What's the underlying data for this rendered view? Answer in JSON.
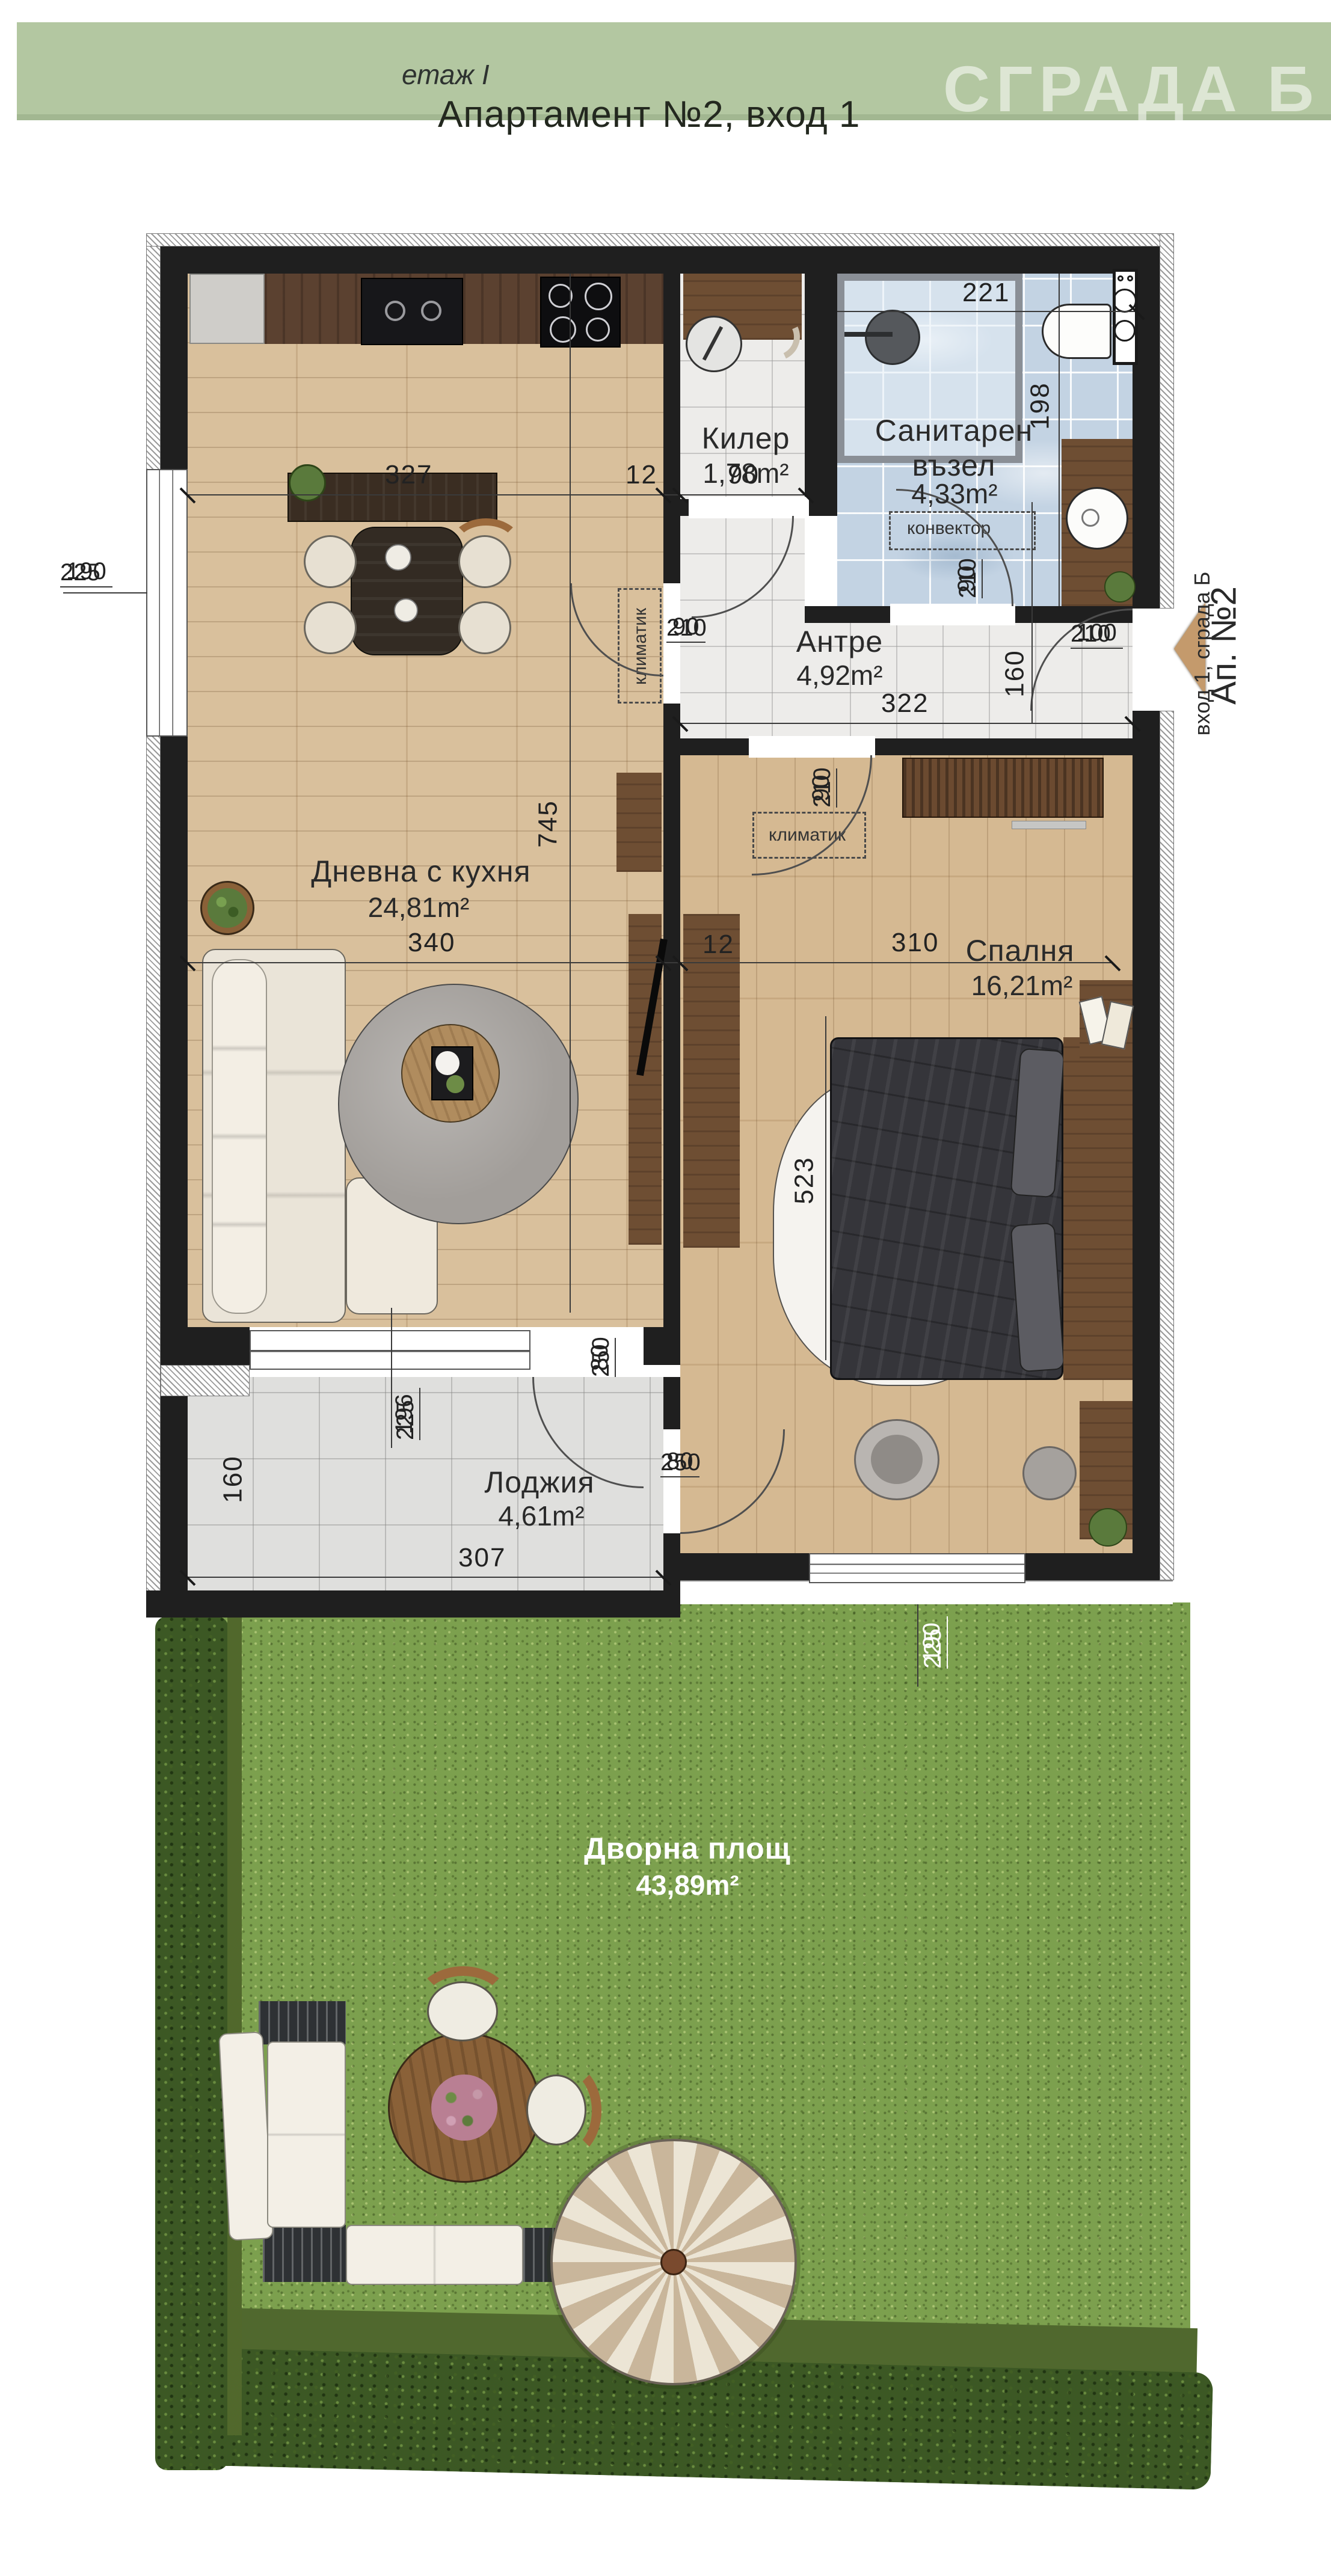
{
  "header": {
    "floor": "етаж I",
    "title": "Апартамент №2, вход 1",
    "watermark": "СГРАДА Б"
  },
  "rooms": {
    "kiler": {
      "name": "Килер",
      "area": "1,78m²"
    },
    "bath": {
      "name": "Санитарен възел",
      "area": "4,33m²"
    },
    "antre": {
      "name": "Антре",
      "area": "4,92m²"
    },
    "living": {
      "name": "Дневна с кухня",
      "area": "24,81m²"
    },
    "bedroom": {
      "name": "Спалня",
      "area": "16,21m²"
    },
    "loggia": {
      "name": "Лоджия",
      "area": "4,61m²"
    },
    "yard": {
      "name": "Дворна площ",
      "area": "43,89m²"
    }
  },
  "annotations": {
    "convector": "конвектор",
    "klimatik_hall": "климатик",
    "klimatik_bed": "климатик"
  },
  "entrance": {
    "apartment": "Ап. №2",
    "building": "вход 1, сграда Б"
  },
  "dims": {
    "top_kitchen": "327",
    "top_wall": "12",
    "top_kiler": "90",
    "bath_w": "221",
    "bath_h": "198",
    "door_bath_w": "90",
    "door_bath_h": "210",
    "antre_w": "322",
    "antre_h": "160",
    "door_living_w": "90",
    "door_living_h": "210",
    "entry_w": "100",
    "entry_h": "210",
    "living_h": "745",
    "mid_living": "340",
    "mid_wall": "12",
    "mid_bedroom": "310",
    "door_bed_w": "90",
    "door_bed_h": "210",
    "bed_h": "523",
    "win_living_w": "190",
    "win_living_h": "225",
    "door_loggia_w": "80",
    "door_loggia_h": "250",
    "win_loggia_w": "196",
    "win_loggia_h": "225",
    "loggia_h": "160",
    "loggia_w": "307",
    "door_bedloggia_w": "80",
    "door_bedloggia_h": "250",
    "win_bed_w": "190",
    "win_bed_h": "225"
  },
  "colors": {
    "header_green": "#b3c7a1",
    "wall_black": "#1f1f1f",
    "living_floor": "#d7bc96",
    "bedroom_floor": "#d3b58c",
    "kitchen_counter": "#5b4130",
    "furniture_wood": "#6e4e33",
    "bath_tile": "#c3d3e3",
    "marble": "#edecea",
    "loggia_tile": "#dfdfdd",
    "grass": "#7ca04e",
    "hedge": "#3c5824",
    "umbrella_stripe": "#c9b69b",
    "entry_arrow": "#c49a6c",
    "dim_text": "#222222",
    "garden_text": "#ffffff"
  }
}
